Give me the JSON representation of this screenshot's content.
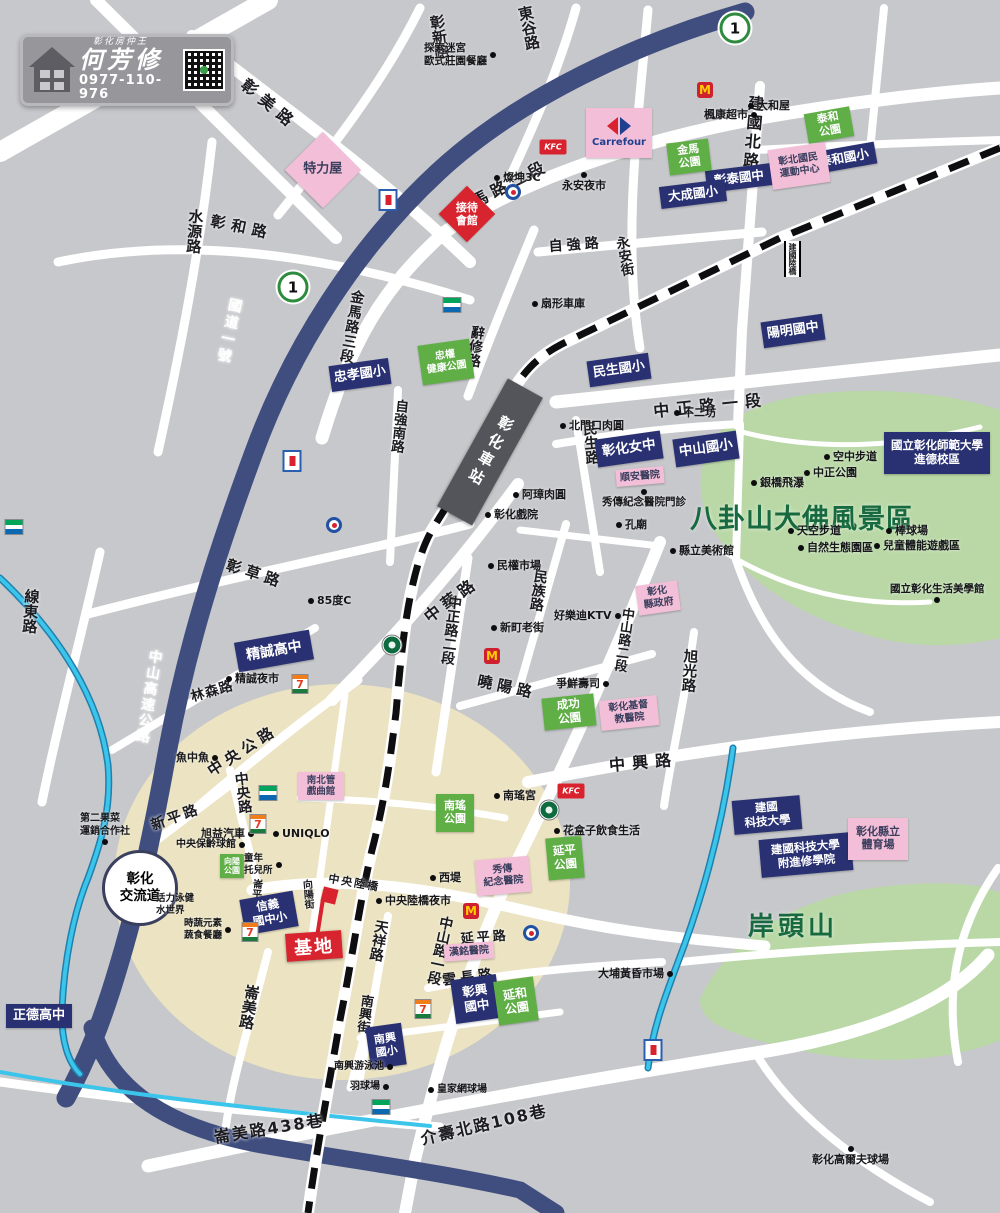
{
  "branding": {
    "tagline": "彰化房仲王",
    "agent_name": "何芳修",
    "phone": "0977-110-976"
  },
  "map": {
    "badge_text": "1",
    "station_label": "彰化車站",
    "interchange_label": "彰化\n交流道",
    "site_label": "基地",
    "icon_glyphs": {
      "mcd": "M",
      "kfc": "KFC",
      "seven": "7",
      "carrefour_word": "Carrefour"
    },
    "badges": [
      {
        "x": 735,
        "y": 28
      },
      {
        "x": 293,
        "y": 287
      }
    ],
    "area_labels": [
      {
        "t": "八卦山大佛風景區",
        "x": 690,
        "y": 497,
        "s": 27,
        "c": "#17693f",
        "ls": 1
      },
      {
        "t": "岸頭山",
        "x": 748,
        "y": 906,
        "s": 26,
        "c": "#17693f",
        "ls": 4
      }
    ],
    "road_labels": [
      {
        "t": "彰新路",
        "x": 426,
        "y": 16,
        "v": 1,
        "r": -8,
        "s": 15
      },
      {
        "t": "東谷路",
        "x": 514,
        "y": 8,
        "v": 1,
        "r": -12,
        "s": 15
      },
      {
        "t": "彰美路",
        "x": 252,
        "y": 72,
        "r": 40,
        "s": 16,
        "ls": 7
      },
      {
        "t": "金馬路二段",
        "x": 448,
        "y": 200,
        "r": -27,
        "s": 16,
        "ls": 5
      },
      {
        "t": "水源路",
        "x": 186,
        "y": 208,
        "v": 1,
        "r": 4,
        "s": 15
      },
      {
        "t": "彰和路",
        "x": 213,
        "y": 210,
        "r": 12,
        "s": 15,
        "ls": 6
      },
      {
        "t": "國道一號",
        "x": 226,
        "y": 296,
        "v": 1,
        "r": 12,
        "s": 14,
        "c": "#ffffff",
        "ls": 3
      },
      {
        "t": "金馬路三段",
        "x": 348,
        "y": 288,
        "v": 1,
        "r": 10,
        "s": 14,
        "ls": 1
      },
      {
        "t": "辭修路",
        "x": 468,
        "y": 324,
        "v": 1,
        "r": 8,
        "s": 14
      },
      {
        "t": "自強路",
        "x": 548,
        "y": 236,
        "r": -4,
        "s": 14,
        "ls": 4
      },
      {
        "t": "永安街",
        "x": 610,
        "y": 238,
        "v": 1,
        "r": -10,
        "s": 13.5
      },
      {
        "t": "建國北路",
        "x": 743,
        "y": 94,
        "v": 1,
        "r": 5,
        "s": 16,
        "ls": 3
      },
      {
        "t": "中正路一段",
        "x": 652,
        "y": 398,
        "r": -6,
        "s": 16,
        "ls": 7
      },
      {
        "t": "自強南路",
        "x": 391,
        "y": 398,
        "v": 1,
        "r": 6,
        "s": 13.5
      },
      {
        "t": "民生路",
        "x": 578,
        "y": 422,
        "v": 1,
        "r": -5,
        "s": 14.5
      },
      {
        "t": "中華路",
        "x": 418,
        "y": 608,
        "r": -37,
        "s": 16,
        "ls": 5
      },
      {
        "t": "中正路二段",
        "x": 445,
        "y": 594,
        "v": 1,
        "r": 7,
        "s": 14
      },
      {
        "t": "中山路二段",
        "x": 618,
        "y": 606,
        "v": 1,
        "r": 8,
        "s": 13
      },
      {
        "t": "旭光路",
        "x": 680,
        "y": 648,
        "v": 1,
        "r": 4,
        "s": 14.5
      },
      {
        "t": "曉陽路",
        "x": 480,
        "y": 670,
        "r": 12,
        "s": 15,
        "ls": 5
      },
      {
        "t": "中興路",
        "x": 608,
        "y": 752,
        "r": -5,
        "s": 16,
        "ls": 7
      },
      {
        "t": "彰草路",
        "x": 230,
        "y": 554,
        "r": 18,
        "s": 15,
        "ls": 5
      },
      {
        "t": "線東路",
        "x": 22,
        "y": 588,
        "v": 1,
        "r": 4,
        "s": 15
      },
      {
        "t": "林森路",
        "x": 188,
        "y": 686,
        "r": -16,
        "s": 13.5,
        "ls": 1
      },
      {
        "t": "中山高速公路",
        "x": 146,
        "y": 648,
        "v": 1,
        "r": 9,
        "s": 14,
        "c": "#ffffff",
        "ls": 2
      },
      {
        "t": "中央公路",
        "x": 203,
        "y": 763,
        "r": -33,
        "s": 15,
        "ls": 5
      },
      {
        "t": "新平路",
        "x": 148,
        "y": 816,
        "r": -20,
        "s": 14,
        "ls": 3
      },
      {
        "t": "中央路",
        "x": 230,
        "y": 773,
        "v": 1,
        "r": -7,
        "s": 14
      },
      {
        "t": "向陽街",
        "x": 298,
        "y": 880,
        "v": 1,
        "r": -5,
        "s": 10
      },
      {
        "t": "崙平南路",
        "x": 249,
        "y": 878,
        "v": 1,
        "r": 5,
        "s": 10
      },
      {
        "t": "天祥路",
        "x": 372,
        "y": 918,
        "v": 1,
        "r": 10,
        "s": 14
      },
      {
        "t": "中山路一段",
        "x": 437,
        "y": 914,
        "v": 1,
        "r": 12,
        "s": 14
      },
      {
        "t": "延平路",
        "x": 460,
        "y": 928,
        "r": -4,
        "s": 13,
        "ls": 3
      },
      {
        "t": "雲長路",
        "x": 441,
        "y": 970,
        "r": -7,
        "s": 14,
        "ls": 4
      },
      {
        "t": "南興街",
        "x": 357,
        "y": 993,
        "v": 1,
        "r": 8,
        "s": 13
      },
      {
        "t": "崙美路",
        "x": 243,
        "y": 983,
        "v": 1,
        "r": 10,
        "s": 15
      },
      {
        "t": "崙美路438巷",
        "x": 212,
        "y": 1124,
        "r": -9,
        "s": 16,
        "ls": 2
      },
      {
        "t": "介壽北路108巷",
        "x": 418,
        "y": 1126,
        "r": -13,
        "s": 16,
        "ls": 2
      },
      {
        "t": "民族路",
        "x": 531,
        "y": 568,
        "v": 1,
        "r": 8,
        "s": 14
      },
      {
        "t": "中央陸橋",
        "x": 330,
        "y": 870,
        "r": 10,
        "s": 11,
        "ls": 2
      },
      {
        "t": "建國陸橋",
        "x": 784,
        "y": 241,
        "v": 1,
        "r": 0,
        "s": 8,
        "bridge": 1
      }
    ],
    "boxes": [
      {
        "t": "泰和國小",
        "x": 812,
        "y": 147,
        "w": 64,
        "h": 22,
        "r": -10,
        "s": 12.5,
        "k": "navy"
      },
      {
        "t": "彰泰國中",
        "x": 706,
        "y": 167,
        "w": 66,
        "h": 22,
        "r": -7,
        "s": 12.5,
        "k": "navy"
      },
      {
        "t": "大成國小",
        "x": 660,
        "y": 183,
        "w": 66,
        "h": 22,
        "r": -7,
        "s": 12.5,
        "k": "navy"
      },
      {
        "t": "陽明國中",
        "x": 762,
        "y": 318,
        "w": 62,
        "h": 26,
        "r": -8,
        "s": 13,
        "k": "navy"
      },
      {
        "t": "民生國小",
        "x": 588,
        "y": 357,
        "w": 62,
        "h": 26,
        "r": -8,
        "s": 13,
        "k": "navy"
      },
      {
        "t": "忠孝國小",
        "x": 330,
        "y": 362,
        "w": 60,
        "h": 26,
        "r": -8,
        "s": 13,
        "k": "navy"
      },
      {
        "t": "彰化女中",
        "x": 596,
        "y": 435,
        "w": 66,
        "h": 28,
        "r": -8,
        "s": 13.5,
        "k": "navy"
      },
      {
        "t": "中山國小",
        "x": 674,
        "y": 435,
        "w": 64,
        "h": 28,
        "r": -8,
        "s": 13.5,
        "k": "navy"
      },
      {
        "t": "國立彰化師範大學\n進德校區",
        "x": 884,
        "y": 432,
        "w": 106,
        "h": 42,
        "r": 0,
        "s": 11.5,
        "k": "navy"
      },
      {
        "t": "精誠高中",
        "x": 236,
        "y": 636,
        "w": 76,
        "h": 30,
        "r": -10,
        "s": 14,
        "k": "navy"
      },
      {
        "t": "信義\n國中小",
        "x": 242,
        "y": 895,
        "w": 54,
        "h": 36,
        "r": -10,
        "s": 11.5,
        "k": "navy"
      },
      {
        "t": "彰興\n國中",
        "x": 453,
        "y": 977,
        "w": 46,
        "h": 44,
        "r": -8,
        "s": 12.5,
        "k": "navy"
      },
      {
        "t": "南興\n國小",
        "x": 368,
        "y": 1025,
        "w": 36,
        "h": 42,
        "r": -8,
        "s": 11,
        "k": "navy"
      },
      {
        "t": "正德高中",
        "x": 6,
        "y": 1004,
        "w": 66,
        "h": 24,
        "r": 0,
        "s": 13,
        "k": "navy"
      },
      {
        "t": "建國\n科技大學",
        "x": 733,
        "y": 798,
        "w": 68,
        "h": 34,
        "r": -5,
        "s": 11.5,
        "k": "navy"
      },
      {
        "t": "建國科技大學\n附進修學院",
        "x": 760,
        "y": 836,
        "w": 92,
        "h": 38,
        "r": -5,
        "s": 11.5,
        "k": "navy"
      },
      {
        "t": "泰和\n公園",
        "x": 806,
        "y": 110,
        "w": 46,
        "h": 30,
        "r": -10,
        "s": 11,
        "k": "green"
      },
      {
        "t": "金馬\n公園",
        "x": 668,
        "y": 141,
        "w": 42,
        "h": 32,
        "r": -7,
        "s": 11,
        "k": "green"
      },
      {
        "t": "忠權\n健康公園",
        "x": 420,
        "y": 342,
        "w": 52,
        "h": 40,
        "r": -8,
        "s": 10,
        "k": "green"
      },
      {
        "t": "成功\n公園",
        "x": 543,
        "y": 696,
        "w": 52,
        "h": 32,
        "r": -6,
        "s": 11.5,
        "k": "green"
      },
      {
        "t": "南瑤\n公園",
        "x": 436,
        "y": 794,
        "w": 38,
        "h": 38,
        "r": 0,
        "s": 11,
        "k": "green"
      },
      {
        "t": "延平\n公園",
        "x": 547,
        "y": 837,
        "w": 36,
        "h": 42,
        "r": -5,
        "s": 11.5,
        "k": "green"
      },
      {
        "t": "延和\n公園",
        "x": 496,
        "y": 979,
        "w": 40,
        "h": 44,
        "r": -8,
        "s": 12,
        "k": "green"
      },
      {
        "t": "向陽\n公園",
        "x": 220,
        "y": 854,
        "w": 24,
        "h": 24,
        "r": 0,
        "s": 8,
        "k": "green"
      },
      {
        "t": "彰北國民\n運動中心",
        "x": 770,
        "y": 146,
        "w": 58,
        "h": 40,
        "r": -8,
        "s": 10,
        "k": "pink"
      },
      {
        "t": "順安醫院",
        "x": 616,
        "y": 468,
        "w": 48,
        "h": 17,
        "r": -5,
        "s": 10,
        "k": "pink"
      },
      {
        "t": "彰化\n縣政府",
        "x": 637,
        "y": 583,
        "w": 42,
        "h": 30,
        "r": -8,
        "s": 10,
        "k": "pink"
      },
      {
        "t": "彰化基督\n教醫院",
        "x": 600,
        "y": 698,
        "w": 58,
        "h": 30,
        "r": -6,
        "s": 10,
        "k": "pink"
      },
      {
        "t": "南北管\n戲曲館",
        "x": 298,
        "y": 772,
        "w": 46,
        "h": 28,
        "r": 0,
        "s": 9.5,
        "k": "pink"
      },
      {
        "t": "秀傳\n紀念醫院",
        "x": 476,
        "y": 858,
        "w": 54,
        "h": 36,
        "r": -5,
        "s": 10,
        "k": "pink"
      },
      {
        "t": "漢銘醫院",
        "x": 444,
        "y": 943,
        "w": 50,
        "h": 17,
        "r": -4,
        "s": 10,
        "k": "pink"
      },
      {
        "t": "彰化縣立\n體育場",
        "x": 848,
        "y": 818,
        "w": 60,
        "h": 42,
        "r": 0,
        "s": 11,
        "k": "pink"
      },
      {
        "t": "接待\n會館",
        "x": 467,
        "y": 214,
        "w": 40,
        "h": 40,
        "r": 45,
        "s": 11,
        "k": "red",
        "dia": 1
      },
      {
        "t": "特力屋",
        "x": 323,
        "y": 170,
        "w": 54,
        "h": 54,
        "r": 45,
        "s": 13,
        "k": "pink",
        "dia": 1
      },
      {
        "t": "",
        "x": 586,
        "y": 108,
        "w": 66,
        "h": 50,
        "r": 0,
        "s": 9,
        "k": "pink",
        "cf": 1
      }
    ],
    "pois": [
      {
        "t": "探索迷宮\n歐式莊園餐廳",
        "x": 424,
        "y": 42,
        "d": "r",
        "s": 10.5
      },
      {
        "t": "大和屋",
        "x": 748,
        "y": 99,
        "d": "l"
      },
      {
        "t": "楓康超市",
        "x": 704,
        "y": 108,
        "d": "r"
      },
      {
        "t": "燦坤3C",
        "x": 494,
        "y": 171,
        "d": "l"
      },
      {
        "t": "永安夜市",
        "x": 562,
        "y": 172,
        "d": "a"
      },
      {
        "t": "扇形車庫",
        "x": 532,
        "y": 297,
        "d": "l"
      },
      {
        "t": "北門口肉圓",
        "x": 560,
        "y": 419,
        "d": "l"
      },
      {
        "t": "不二坊",
        "x": 674,
        "y": 406,
        "d": "l"
      },
      {
        "t": "阿璋肉圓",
        "x": 513,
        "y": 488,
        "d": "l"
      },
      {
        "t": "彰化戲院",
        "x": 485,
        "y": 508,
        "d": "l"
      },
      {
        "t": "秀傳紀念醫院門診",
        "x": 602,
        "y": 489,
        "d": "a",
        "s": 10.5
      },
      {
        "t": "孔廟",
        "x": 616,
        "y": 518,
        "d": "l"
      },
      {
        "t": "縣立美術館",
        "x": 670,
        "y": 544,
        "d": "l"
      },
      {
        "t": "空中步道",
        "x": 824,
        "y": 450,
        "d": "l"
      },
      {
        "t": "中正公園",
        "x": 804,
        "y": 466,
        "d": "l"
      },
      {
        "t": "銀橋飛瀑",
        "x": 751,
        "y": 476,
        "d": "l"
      },
      {
        "t": "天空步道",
        "x": 788,
        "y": 524,
        "d": "l"
      },
      {
        "t": "自然生態園區",
        "x": 798,
        "y": 541,
        "d": "l"
      },
      {
        "t": "棒球場",
        "x": 886,
        "y": 524,
        "d": "l"
      },
      {
        "t": "兒童體能遊戲區",
        "x": 874,
        "y": 539,
        "d": "l"
      },
      {
        "t": "國立彰化生活美學館",
        "x": 890,
        "y": 583,
        "d": "b",
        "s": 10.5
      },
      {
        "t": "民權市場",
        "x": 488,
        "y": 559,
        "d": "l"
      },
      {
        "t": "好樂迪KTV",
        "x": 554,
        "y": 609,
        "d": "r"
      },
      {
        "t": "新町老街",
        "x": 491,
        "y": 621,
        "d": "l"
      },
      {
        "t": "85度C",
        "x": 308,
        "y": 594,
        "d": "l"
      },
      {
        "t": "精誠夜市",
        "x": 226,
        "y": 672,
        "d": "l"
      },
      {
        "t": "爭鮮壽司",
        "x": 556,
        "y": 677,
        "d": "r"
      },
      {
        "t": "魚中魚",
        "x": 176,
        "y": 751,
        "d": "r"
      },
      {
        "t": "旭益汽車",
        "x": 201,
        "y": 827,
        "d": "r"
      },
      {
        "t": "中央保齡球館",
        "x": 176,
        "y": 839,
        "d": "r",
        "s": 10
      },
      {
        "t": "UNIQLO",
        "x": 273,
        "y": 827,
        "d": "l"
      },
      {
        "t": "童年\n托兒所",
        "x": 244,
        "y": 853,
        "d": "r",
        "s": 9.5
      },
      {
        "t": "第二果菜\n運銷合作社",
        "x": 80,
        "y": 813,
        "d": "b",
        "s": 10
      },
      {
        "t": "時蔬元素\n蔬食餐廳",
        "x": 184,
        "y": 918,
        "d": "r",
        "s": 9.5
      },
      {
        "t": "活力泳健\n水世界",
        "x": 156,
        "y": 893,
        "d": "n",
        "s": 9.5
      },
      {
        "t": "中央陸橋夜市",
        "x": 376,
        "y": 894,
        "d": "l"
      },
      {
        "t": "西堤",
        "x": 430,
        "y": 871,
        "d": "l"
      },
      {
        "t": "南瑤宮",
        "x": 494,
        "y": 789,
        "d": "l"
      },
      {
        "t": "花盒子飲食生活",
        "x": 554,
        "y": 824,
        "d": "l"
      },
      {
        "t": "南興游泳池",
        "x": 334,
        "y": 1061,
        "d": "r",
        "s": 10
      },
      {
        "t": "羽球場",
        "x": 350,
        "y": 1081,
        "d": "r",
        "s": 10
      },
      {
        "t": "皇家網球場",
        "x": 428,
        "y": 1084,
        "d": "l",
        "s": 10
      },
      {
        "t": "大埔黃昏市場",
        "x": 598,
        "y": 967,
        "d": "r"
      },
      {
        "t": "彰化高爾夫球場",
        "x": 812,
        "y": 1146,
        "d": "a"
      }
    ],
    "icons": [
      {
        "k": "mcd",
        "x": 705,
        "y": 90
      },
      {
        "k": "mcd",
        "x": 492,
        "y": 656
      },
      {
        "k": "mcd",
        "x": 471,
        "y": 911
      },
      {
        "k": "kfc",
        "x": 553,
        "y": 147
      },
      {
        "k": "kfc",
        "x": 571,
        "y": 791
      },
      {
        "k": "seven",
        "x": 300,
        "y": 684
      },
      {
        "k": "seven",
        "x": 258,
        "y": 824
      },
      {
        "k": "seven",
        "x": 250,
        "y": 932
      },
      {
        "k": "seven",
        "x": 423,
        "y": 1009
      },
      {
        "k": "fam",
        "x": 452,
        "y": 305
      },
      {
        "k": "fam",
        "x": 268,
        "y": 793
      },
      {
        "k": "fam",
        "x": 381,
        "y": 1107
      },
      {
        "k": "fam",
        "x": 14,
        "y": 527
      },
      {
        "k": "sbx",
        "x": 392,
        "y": 645
      },
      {
        "k": "sbx",
        "x": 549,
        "y": 810
      },
      {
        "k": "brand",
        "x": 513,
        "y": 192
      },
      {
        "k": "brand",
        "x": 334,
        "y": 525
      },
      {
        "k": "brand",
        "x": 531,
        "y": 933
      },
      {
        "k": "gas",
        "x": 388,
        "y": 200
      },
      {
        "k": "gas",
        "x": 292,
        "y": 461
      },
      {
        "k": "gas",
        "x": 653,
        "y": 1050
      }
    ]
  }
}
